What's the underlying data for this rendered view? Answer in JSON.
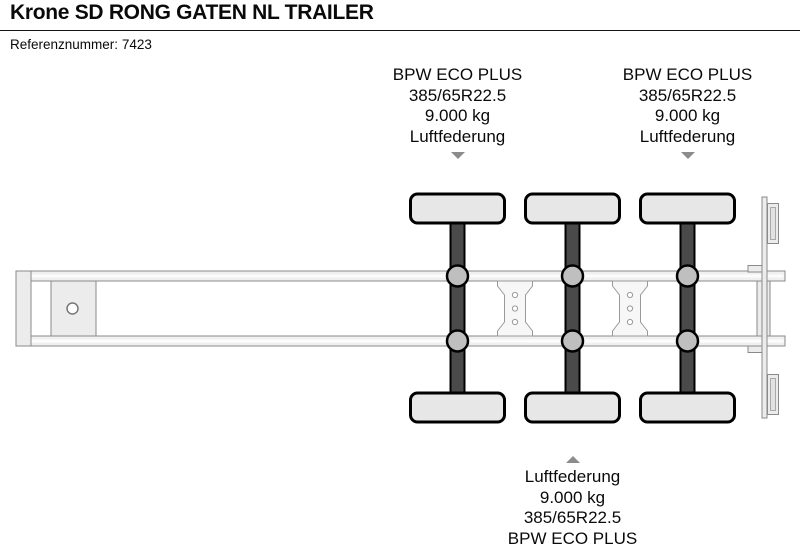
{
  "header": {
    "title": "Krone SD RONG GATEN NL TRAILER",
    "reference_label": "Referenznummer:",
    "reference_value": "7423"
  },
  "annotations": {
    "top_left": {
      "icon": "arrow-down-icon",
      "lines": [
        "BPW ECO PLUS",
        "385/65R22.5",
        "9.000 kg",
        "Luftfederung"
      ]
    },
    "top_right": {
      "icon": "arrow-down-icon",
      "lines": [
        "BPW ECO PLUS",
        "385/65R22.5",
        "9.000 kg",
        "Luftfederung"
      ]
    },
    "bottom": {
      "icon": "arrow-up-icon",
      "lines": [
        "Luftfederung",
        "9.000 kg",
        "385/65R22.5",
        "BPW ECO PLUS"
      ]
    }
  },
  "diagram": {
    "type": "trailer-chassis-top-view",
    "axle_count": 3,
    "wheels_per_axle": 2
  },
  "colors": {
    "text_color": "#0a0a0a",
    "rule_color": "#151515",
    "arrow_color": "#8c8c8c",
    "rail_fill": "#f0f0f0",
    "plate_fill": "#ececec",
    "axle_fill": "#4a4a4a",
    "wheel_fill": "#e7e7e7",
    "hub_fill": "#bfbfbf",
    "outline_gray": "#8a8a8a"
  }
}
